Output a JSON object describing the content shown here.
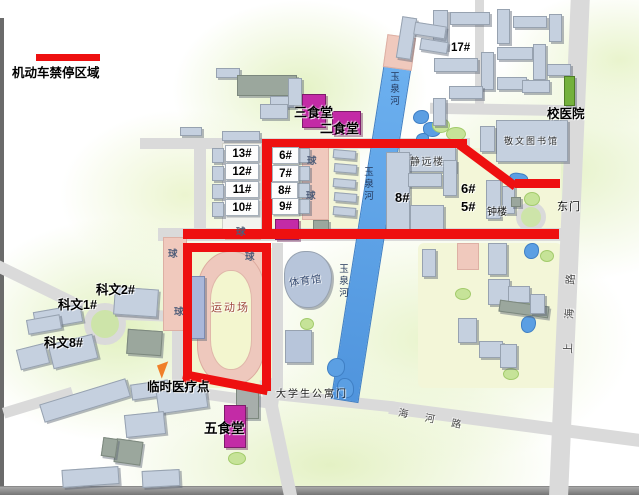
{
  "legend": {
    "no_parking": "机动车禁停区域"
  },
  "buildings": {
    "b17": "17#",
    "b13": "13#",
    "b12": "12#",
    "b11": "11#",
    "b10": "10#",
    "b6w": "6#",
    "b7w": "7#",
    "b8w": "8#",
    "b9w": "9#",
    "b8": "8#",
    "b6": "6#",
    "b5": "5#",
    "kewen2": "科文2#",
    "kewen1": "科文1#",
    "kewen8": "科文8#"
  },
  "places": {
    "hospital": "校医院",
    "library": "敬文图书馆",
    "canteen3": "三食堂",
    "canteen2": "二食堂",
    "canteen5": "五食堂",
    "jingyuan": "静远楼",
    "bell_tower": "钟楼",
    "east_gate": "东门",
    "stadium": "运动场",
    "gym": "体育馆",
    "medical": "临时医疗点",
    "apartment_gate": "大学生公寓门",
    "court": "球"
  },
  "water": {
    "river": "玉泉河"
  },
  "roads": {
    "shanghai": "上海路",
    "haihe": "海河路"
  },
  "colors": {
    "red": "#ee1010",
    "magenta": "#c32ba6",
    "green": "#74b13c",
    "blue": "#5b9fe3",
    "pink": "#f0c9bd",
    "bld": "#c5d0df",
    "road": "#dadada"
  }
}
